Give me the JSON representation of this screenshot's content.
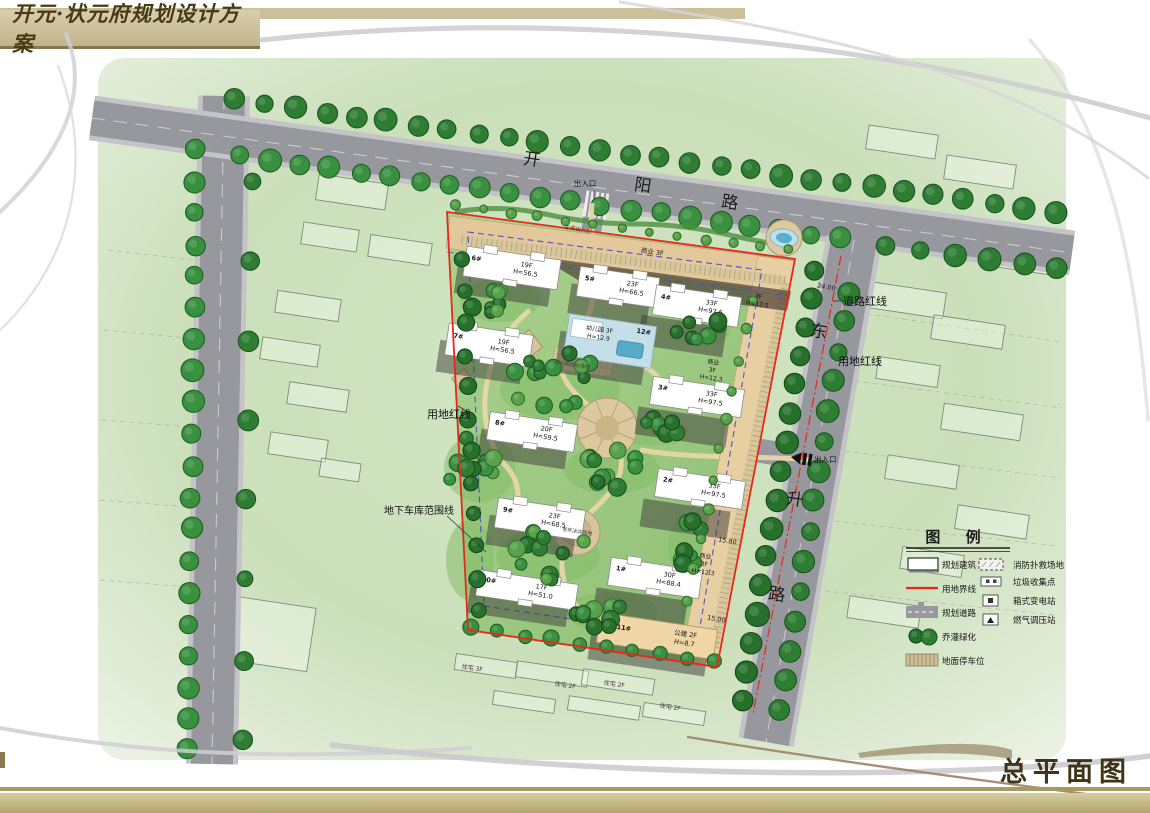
{
  "header": {
    "title": "开元·状元府规划设计方案"
  },
  "footer": {
    "caption": "总平面图"
  },
  "plan": {
    "road_names": {
      "north": "开阳路",
      "east": "东升路"
    },
    "buildings": [
      {
        "id": "6#",
        "floors": "19F",
        "height": "H=56.5"
      },
      {
        "id": "5#",
        "floors": "23F",
        "height": "H=66.5"
      },
      {
        "id": "4#",
        "floors": "33F",
        "height": "H=97.6"
      },
      {
        "id": "7#",
        "floors": "19F",
        "height": "H=56.5"
      },
      {
        "id": "12#",
        "name": "幼儿园",
        "floors": "3F",
        "height": "H=12.9"
      },
      {
        "id": "3#",
        "floors": "33F",
        "height": "H=97.5"
      },
      {
        "id": "8#",
        "floors": "20F",
        "height": "H=59.5"
      },
      {
        "id": "2#",
        "floors": "33F",
        "height": "H=97.5"
      },
      {
        "id": "9#",
        "floors": "23F",
        "height": "H=68.5"
      },
      {
        "id": "10#",
        "floors": "17F",
        "height": "H=51.0"
      },
      {
        "id": "1#",
        "floors": "30F",
        "height": "H=88.4"
      },
      {
        "id": "11#",
        "name": "公建",
        "floors": "2F",
        "height": "H=8.7"
      }
    ],
    "commercial_labels": [
      {
        "name": "商业",
        "floors": "3F",
        "height": ""
      },
      {
        "name": "商业",
        "floors": "3F",
        "height": "H=12.3"
      },
      {
        "name": "商业",
        "floors": "3F",
        "height": "H=12.3"
      },
      {
        "name": "",
        "floors": "3F",
        "height": "H=13.5"
      }
    ],
    "annotations": [
      {
        "id": "entrance-north",
        "text": "出入口"
      },
      {
        "id": "garage-entrance",
        "text": "车库出入口"
      },
      {
        "id": "road-redline",
        "text": "道路红线"
      },
      {
        "id": "site-redline-east",
        "text": "用地红线"
      },
      {
        "id": "site-redline-west",
        "text": "用地红线"
      },
      {
        "id": "garage-outline",
        "text": "地下车库范围线"
      },
      {
        "id": "entrance-east",
        "text": "出入口"
      },
      {
        "id": "kindergarten-yard",
        "text": "幼儿园活动场地"
      },
      {
        "id": "elder-plaza",
        "text": "老年活动场地"
      }
    ],
    "dimensions": [
      "24.00",
      "15.80",
      "15.00"
    ],
    "context_labels": [
      "住宅 3F",
      "住宅 2F",
      "住宅 2F",
      "住宅 2F"
    ]
  },
  "legend": {
    "title": "图 例",
    "left": [
      {
        "icon": "building-icon",
        "label": "规划建筑"
      },
      {
        "icon": "boundary-icon",
        "label": "用地界线"
      },
      {
        "icon": "road-icon",
        "label": "规划道路"
      },
      {
        "icon": "greenery-icon",
        "label": "乔灌绿化"
      },
      {
        "icon": "parking-icon",
        "label": "地面停车位"
      }
    ],
    "right": [
      {
        "icon": "fire-rescue-icon",
        "label": "消防扑救场地"
      },
      {
        "icon": "garbage-icon",
        "label": "垃圾收集点"
      },
      {
        "icon": "transformer-icon",
        "label": "箱式变电站"
      },
      {
        "icon": "gas-station-icon",
        "label": "燃气调压站"
      }
    ]
  },
  "colors": {
    "banner_bg": "#c9bd98",
    "banner_text": "#4a3a18",
    "gold_band": "#a89a5f",
    "khaki_band": "#c9bd8f",
    "redline": "#e8281a",
    "road": "#97979e",
    "site_green": "#9cc87e",
    "tree_green": "#2e7d33",
    "commercial_tan": "#e3c89b",
    "water_blue": "#57abc9"
  }
}
